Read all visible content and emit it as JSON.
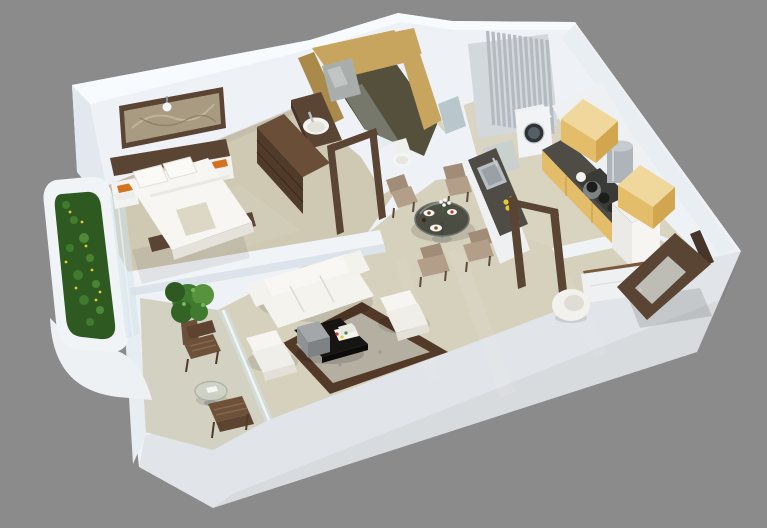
{
  "scene": {
    "title": "3D isometric floor plan render of a one-bedroom apartment on a gray background",
    "view": "top-down isometric 3D render, glossy beige floors, white walls",
    "rooms": [
      {
        "name": "bedroom",
        "furniture": [
          "double-bed",
          "pillows",
          "wooden-headboard",
          "two-nightstands",
          "chest-of-drawers",
          "framed-wall-art",
          "wall-lamp"
        ]
      },
      {
        "name": "bedroom-balcony",
        "furniture": [
          "curved-white-planter",
          "green-hedge",
          "glass-railing"
        ]
      },
      {
        "name": "bathroom",
        "furniture": [
          "wash-basin",
          "mirror",
          "glass-shower-partition",
          "toilet",
          "open-door-frame"
        ],
        "finish": "golden wall tiles, dark olive floor"
      },
      {
        "name": "utility-nook",
        "furniture": [
          "gray-louver-screen",
          "washing-machine",
          "small-window"
        ]
      },
      {
        "name": "kitchen",
        "furniture": [
          "l-shaped-counter",
          "steel-sink",
          "gas-stove-with-pots",
          "chimney-hood",
          "two-overhead-yellow-cabinets",
          "refrigerator",
          "flower-vase",
          "open-door-frame"
        ]
      },
      {
        "name": "dining-area",
        "furniture": [
          "round-glass-table",
          "four-upholstered-chairs",
          "plates-of-food",
          "white-flower-vase"
        ]
      },
      {
        "name": "living-room",
        "furniture": [
          "white-three-seat-sofa",
          "two-white-armchairs",
          "black-coffee-table",
          "gray-storage-box",
          "magazines",
          "brown-bordered-area-rug"
        ]
      },
      {
        "name": "sit-out-balcony",
        "furniture": [
          "two-wooden-chairs",
          "round-glass-side-table",
          "potted-plant",
          "glass-railing"
        ]
      },
      {
        "name": "entry",
        "furniture": [
          "open-wooden-entrance-door",
          "white-bench-with-wood-top",
          "round-white-pouf"
        ]
      }
    ]
  },
  "palette": {
    "bg": "#8b8b8b",
    "wall-top": "#f8fbfd",
    "wall-face": "#eef2f6",
    "wall-face-dark": "#dde3ea",
    "wall-white": "#eef1f5",
    "floor-main": "#d6d1bc",
    "floor-bed": "#cfc9b4",
    "floor-kitchen": "#d9d4c0",
    "floor-hall": "#d9d5c2",
    "floor-balcony": "#d3d2c2",
    "floor-bath": "#55503c",
    "gold": "#c7a55e",
    "gold-dark": "#a98a4b",
    "walnut": "#5a4433",
    "walnut-dark": "#46352a",
    "walnut-light": "#7a5a3e",
    "cabinet-top": "#f0d89c",
    "cabinet-front": "#e3bd6a",
    "cabinet-side": "#d2a64f",
    "counter": "#4e4c44",
    "steel": "#b9bec4",
    "slat": "#b4bac0",
    "sofa": "#f4f3ee",
    "rug-border": "#533928",
    "rug-center": "#b5afa2",
    "chair": "#a18d77",
    "chair-light": "#b39f89",
    "green": "#3f7a2e",
    "green-dark": "#2e5a21",
    "green-light": "#57933c",
    "glass": "#cfe3ea",
    "accent-orange": "#d3711f",
    "flower-yellow": "#e8c832",
    "flower-red": "#c0392b"
  }
}
